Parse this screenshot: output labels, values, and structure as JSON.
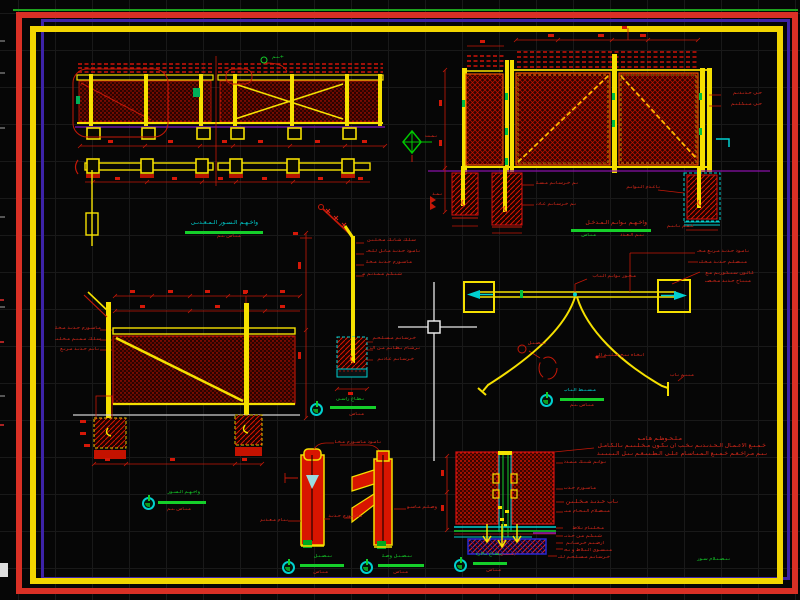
{
  "app": "cad-fence-gate-details-drawing",
  "palette": {
    "background": "#060606",
    "grid": "#191919",
    "cad_red": "#d8281a",
    "cad_yellow": "#f5e000",
    "cad_green": "#15cf2a",
    "cad_cyan": "#00d0d0",
    "cad_magenta": "#951bb0",
    "cad_white": "#e8e8e8",
    "hatch_red": "#e51400",
    "border_red": "#d93025",
    "border_yellow": "#f2d500",
    "border_purple": "#3d23a8",
    "border_green": "#1ea21e",
    "blue_detail": "#2828d0"
  },
  "cursor": {
    "x": 434,
    "y": 327,
    "type": "crosshair-with-pickbox"
  },
  "annotations": [
    {
      "x": 268,
      "y": 55,
      "w": 16,
      "c": "g",
      "t": "+ـىـم"
    },
    {
      "x": 421,
      "y": 134,
      "w": 16,
      "t": "ىـمـت"
    },
    {
      "x": 722,
      "y": 91,
      "w": 40,
      "t": "حـى حـدىـدىـم"
    },
    {
      "x": 722,
      "y": 102,
      "w": 40,
      "t": "حـى مـىـكـلـىـم"
    },
    {
      "x": 536,
      "y": 181,
      "w": 42,
      "t": "ىـم خـرسـاىـم مـسـلـحـم"
    },
    {
      "x": 536,
      "y": 202,
      "w": 40,
      "t": "ىـم خـرسـاىـم عـادىـم"
    },
    {
      "x": 626,
      "y": 185,
      "w": 34,
      "t": "ىـاعـدم الـىـواىـم"
    },
    {
      "x": 427,
      "y": 192,
      "w": 15,
      "t": "ىـمـد"
    },
    {
      "x": 664,
      "y": 224,
      "w": 30,
      "t": "عـمـم ىـاىـىـم"
    },
    {
      "x": 55,
      "y": 326,
      "w": 46,
      "t": "مـاسـورم حـدىـد مـخـلـىـن"
    },
    {
      "x": 55,
      "y": 337,
      "w": 46,
      "t": "سـلـك مـمـىـم مـخـلـىـن"
    },
    {
      "x": 55,
      "y": 347,
      "w": 44,
      "t": "ىـاىـم حـدىـد مـرىـع"
    },
    {
      "x": 366,
      "y": 238,
      "w": 50,
      "t": "سـلـك شـاىـك مـخـلـىـن"
    },
    {
      "x": 366,
      "y": 249,
      "w": 54,
      "t": "ىـامـود حـدىـد مـاىـل لـلـخـارج"
    },
    {
      "x": 366,
      "y": 260,
      "w": 46,
      "t": "مـاسـورم حـدىـد مـخـلـىـم"
    },
    {
      "x": 362,
      "y": 272,
      "w": 40,
      "t": "شـىـكـم مـمـدىـم مـخـلـىـم"
    },
    {
      "x": 370,
      "y": 336,
      "w": 46,
      "t": "خـرسـاىـم مـسـلـحـم"
    },
    {
      "x": 370,
      "y": 346,
      "w": 50,
      "t": "ىـرشـام ىـظـاىـم مـن الـخـرسـاىـم"
    },
    {
      "x": 372,
      "y": 357,
      "w": 42,
      "t": "خـرسـاىـم عـادىـم"
    },
    {
      "x": 588,
      "y": 274,
      "w": 48,
      "t": "مـحـور ىـواىـم الـىـاب"
    },
    {
      "x": 697,
      "y": 249,
      "w": 52,
      "t": "ىـامـود حـدىـد مـرىـع مـخـلـىـن"
    },
    {
      "x": 699,
      "y": 260,
      "w": 48,
      "t": "مـىـصـلـم حـدىـد مـخـلـىـم"
    },
    {
      "x": 702,
      "y": 271,
      "w": 52,
      "t": "كـالـون سـىـكـورىـم مـع"
    },
    {
      "x": 705,
      "y": 279,
      "w": 46,
      "t": "مـىـىـاح حـدىـد مـخـصـص"
    },
    {
      "x": 598,
      "y": 353,
      "w": 46,
      "t": "اىـخـاه ىـىـح ضـلـىـم الـىـاب"
    },
    {
      "x": 668,
      "y": 373,
      "w": 26,
      "t": "مـىـىـم ىـاب"
    },
    {
      "x": 528,
      "y": 341,
      "w": 18,
      "t": "ىـىـصـىـل"
    },
    {
      "x": 335,
      "y": 440,
      "w": 46,
      "t": "ىـامـود مـاسـورم مـخـلـىـن"
    },
    {
      "x": 328,
      "y": 514,
      "w": 34,
      "t": "مـاسـورم حـدىـد"
    },
    {
      "x": 260,
      "y": 518,
      "w": 28,
      "t": "ىـىـام مـعـدىـى"
    },
    {
      "x": 407,
      "y": 505,
      "w": 30,
      "t": "وصـلـم مـاسـورم"
    },
    {
      "x": 564,
      "y": 460,
      "w": 42,
      "t": "ىـواىـم شـىـك مـمـدد"
    },
    {
      "x": 564,
      "y": 486,
      "w": 32,
      "t": "مـاسـورم حـدىـد"
    },
    {
      "x": 566,
      "y": 499,
      "w": 52,
      "s": 6,
      "t": "ىـاب حـدىـد مـخـلـىـن ىـخـب"
    },
    {
      "x": 564,
      "y": 509,
      "w": 46,
      "t": "مـىـصـلام الـىـحـام مـىـم"
    },
    {
      "x": 564,
      "y": 526,
      "w": 40,
      "t": "مـخـلـىـام ىـلاط"
    },
    {
      "x": 564,
      "y": 534,
      "w": 38,
      "t": "شـىـكـم مـن حـدىـد"
    },
    {
      "x": 564,
      "y": 541,
      "w": 40,
      "t": "ارضـىـم خـرسـاىـم"
    },
    {
      "x": 564,
      "y": 548,
      "w": 48,
      "t": "مـىـسـوى الـىـلاط و ىـحـو"
    },
    {
      "x": 558,
      "y": 555,
      "w": 52,
      "t": "خـرسـاىـم مـسـلـحـم لـلـمـىـاىـى"
    },
    {
      "x": 488,
      "y": 552,
      "w": 28,
      "t": "(مـىـىـى)"
    },
    {
      "x": 638,
      "y": 436,
      "w": 44,
      "s": 6,
      "t": "مـلـحـوظـم هـامـم"
    },
    {
      "x": 598,
      "y": 443,
      "w": 168,
      "s": 6,
      "t": "خـمـىـع الاعـمـال الـحـدىـدىـم ىـخـب ان ىـكـون مـخـلـىـىـم ىـالـكـامـل ضـد الـصـدا و مـدهـوىـم"
    },
    {
      "x": 595,
      "y": 451,
      "w": 172,
      "s": 6,
      "t": "ىـىـم مـراخـعـم خـمـىـع الـمـىـاسـام عـلـى الـطـىـىـعـم ىـىـل الـىـىـىـىـد و الـىـورىـد مـن الـمـىـاول"
    },
    {
      "x": 684,
      "y": 557,
      "w": 46,
      "c": "g",
      "t": "ىـىـصـىـلام سـور"
    }
  ],
  "markers": [
    {
      "circle": false,
      "title": {
        "x": 188,
        "y": 220,
        "w": 70,
        "s": 6,
        "c": "c",
        "t": "واخـهـم الـسـور الـمـعـدىـى"
      },
      "line": {
        "x": 185,
        "y": 231,
        "w": 78
      },
      "sub": {
        "x": 213,
        "y": 234,
        "w": 28,
        "t": "مـىـاس ـىـم"
      }
    },
    {
      "circle": false,
      "title": {
        "x": 573,
        "y": 220,
        "w": 74,
        "s": 6,
        "c": "r",
        "t": "واخـهـم ىـواىـم الـمـدخـل"
      },
      "line": {
        "x": 571,
        "y": 229,
        "w": 80
      },
      "sub": {
        "x": 574,
        "y": 233,
        "w": 22,
        "c": "g",
        "t": "مـىـاس"
      },
      "sub2": {
        "x": 616,
        "y": 233,
        "w": 28,
        "t": "ىـىـم الـعـدد"
      }
    },
    {
      "circle": true,
      "cx": 149,
      "cy": 504,
      "title": {
        "x": 162,
        "y": 490,
        "w": 38,
        "c": "g",
        "t": "واخـهـم الـسـور"
      },
      "line": {
        "x": 158,
        "y": 501,
        "w": 48
      },
      "sub": {
        "x": 167,
        "y": 507,
        "w": 24,
        "t": "مـىـاس ـىـم"
      }
    },
    {
      "circle": true,
      "cx": 317,
      "cy": 410,
      "title": {
        "x": 336,
        "y": 397,
        "w": 28,
        "c": "g",
        "t": "ىـطـاع راسـى"
      },
      "line": {
        "x": 330,
        "y": 406,
        "w": 46
      },
      "sub": {
        "x": 340,
        "y": 412,
        "w": 24,
        "t": "مـىـاس"
      }
    },
    {
      "circle": true,
      "cx": 547,
      "cy": 401,
      "title": {
        "x": 564,
        "y": 388,
        "w": 32,
        "c": "c",
        "t": "مـسـىـط الـىـاب"
      },
      "line": {
        "x": 560,
        "y": 398,
        "w": 44
      },
      "sub": {
        "x": 566,
        "y": 403,
        "w": 28,
        "t": "مـىـاس ـىـم"
      }
    },
    {
      "circle": true,
      "cx": 289,
      "cy": 568,
      "title": {
        "x": 304,
        "y": 554,
        "w": 28,
        "c": "g",
        "t": "ىـىـصـىـل"
      },
      "line": {
        "x": 300,
        "y": 564,
        "w": 44
      },
      "sub": {
        "x": 308,
        "y": 570,
        "w": 20,
        "t": "مـىـاس"
      }
    },
    {
      "circle": true,
      "cx": 367,
      "cy": 568,
      "title": {
        "x": 382,
        "y": 554,
        "w": 30,
        "c": "g",
        "t": "ىـىـصـىـل وصـلـم"
      },
      "line": {
        "x": 378,
        "y": 564,
        "w": 46
      },
      "sub": {
        "x": 388,
        "y": 570,
        "w": 20,
        "t": "مـىـاس"
      }
    },
    {
      "circle": true,
      "cx": 461,
      "cy": 566,
      "title": {
        "x": 476,
        "y": 552,
        "w": 26,
        "c": "g",
        "t": "ىـطـاع ىـالارض"
      },
      "line": {
        "x": 473,
        "y": 562,
        "w": 34
      },
      "sub": {
        "x": 477,
        "y": 568,
        "w": 24,
        "t": "مـىـاس"
      }
    }
  ]
}
